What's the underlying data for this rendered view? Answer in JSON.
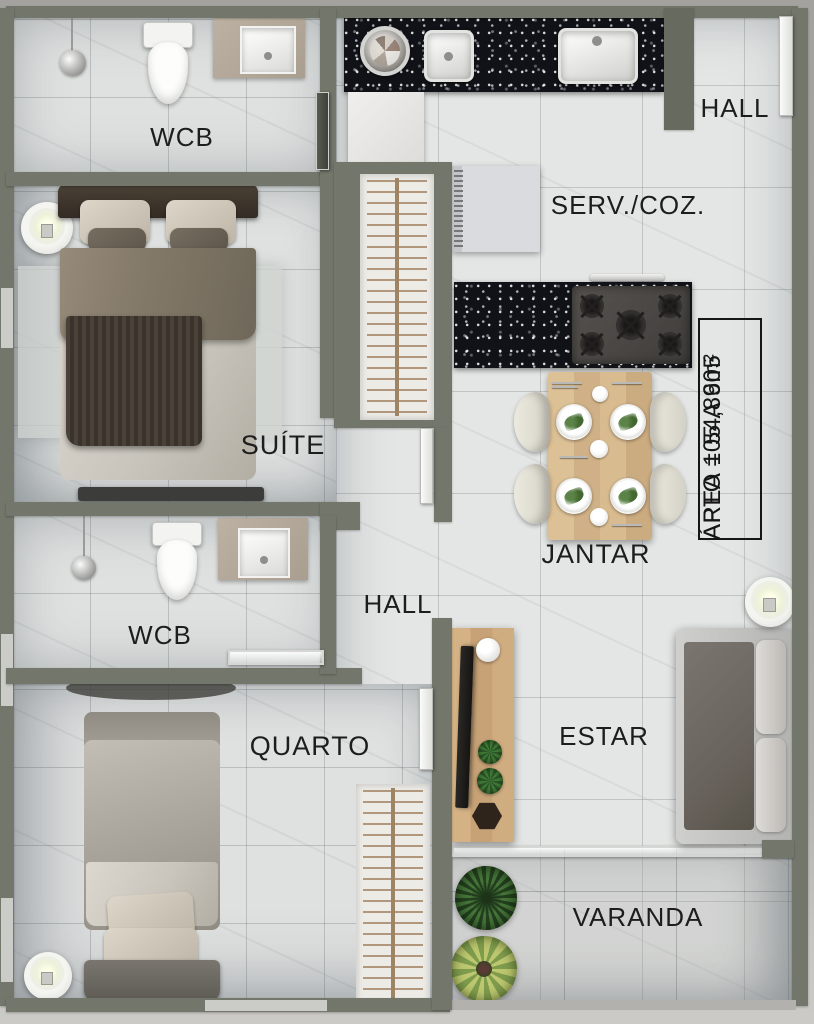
{
  "plan": {
    "rooms": {
      "wcb_suite": {
        "label": "WCB"
      },
      "suite": {
        "label": "SUÍTE"
      },
      "wcb_social": {
        "label": "WCB"
      },
      "hall_internal": {
        "label": "HALL"
      },
      "quarto": {
        "label": "QUARTO"
      },
      "serv_coz": {
        "label": "SERV./COZ."
      },
      "hall_entry": {
        "label": "HALL"
      },
      "jantar": {
        "label": "JANTAR"
      },
      "estar": {
        "label": "ESTAR"
      },
      "varanda": {
        "label": "VARANDA"
      }
    },
    "info_box": {
      "line1": "APTO 105 A 605",
      "line2": "ÁREA = 54,89m²"
    },
    "colors": {
      "wall": "#73766a",
      "floor_marble": "#dfe1e0",
      "granite_counter": "#111217",
      "wood": "#d0b187",
      "label_text": "#1d1d1d",
      "background": "#a7a6a2"
    }
  }
}
